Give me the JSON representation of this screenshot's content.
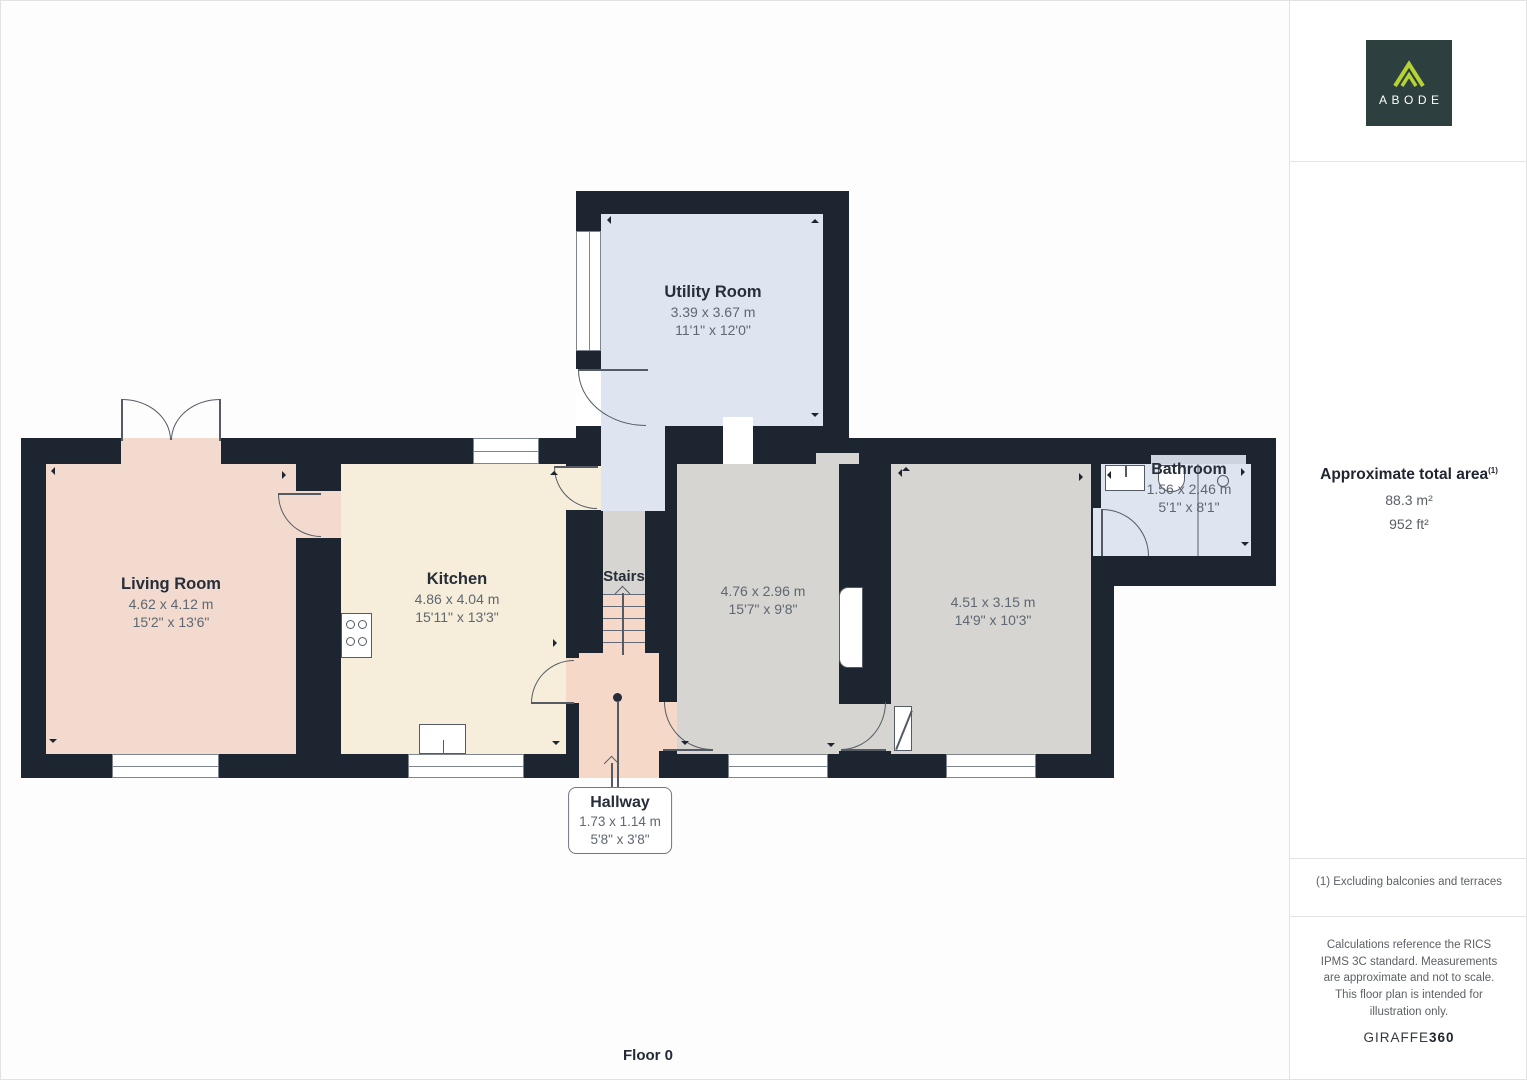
{
  "page": {
    "floor_label": "Floor 0"
  },
  "branding": {
    "logo_text": "ABODE",
    "logo_bg": "#2e3f40",
    "logo_accent": "#b5d334"
  },
  "sidebar": {
    "area_title": "Approximate total area",
    "area_note_ref": "(1)",
    "area_metric": "88.3 m²",
    "area_imperial": "952 ft²",
    "footnote": "(1) Excluding balconies and terraces",
    "disclaimer": "Calculations reference the RICS IPMS 3C standard. Measurements are approximate and not to scale. This floor plan is intended for illustration only.",
    "brand_name": "GIRAFFE",
    "brand_suffix": "360"
  },
  "rooms": {
    "utility": {
      "name": "Utility Room",
      "metric": "3.39 x 3.67 m",
      "imperial": "11'1\" x 12'0\""
    },
    "living": {
      "name": "Living Room",
      "metric": "4.62 x 4.12 m",
      "imperial": "15'2\" x 13'6\""
    },
    "kitchen": {
      "name": "Kitchen",
      "metric": "4.86 x 4.04 m",
      "imperial": "15'11\" x 13'3\""
    },
    "stairs": {
      "name": "Stairs"
    },
    "hallway": {
      "name": "Hallway",
      "metric": "1.73 x 1.14 m",
      "imperial": "5'8\" x 3'8\""
    },
    "room_a": {
      "metric": "4.76 x 2.96 m",
      "imperial": "15'7\" x 9'8\""
    },
    "room_b": {
      "metric": "4.51 x 3.15 m",
      "imperial": "14'9\" x 10'3\""
    },
    "bathroom": {
      "name": "Bathroom",
      "metric": "1.56 x 2.46 m",
      "imperial": "5'1\" x 8'1\""
    }
  },
  "colors": {
    "wall": "#1d2531",
    "living_fill": "#f2dbce",
    "kitchen_fill": "#f6eedb",
    "utility_fill": "#dfe5f0",
    "gray_room_fill": "#d7d5d2",
    "hall_fill": "#f5d8c8",
    "background": "#fdfdfd"
  }
}
